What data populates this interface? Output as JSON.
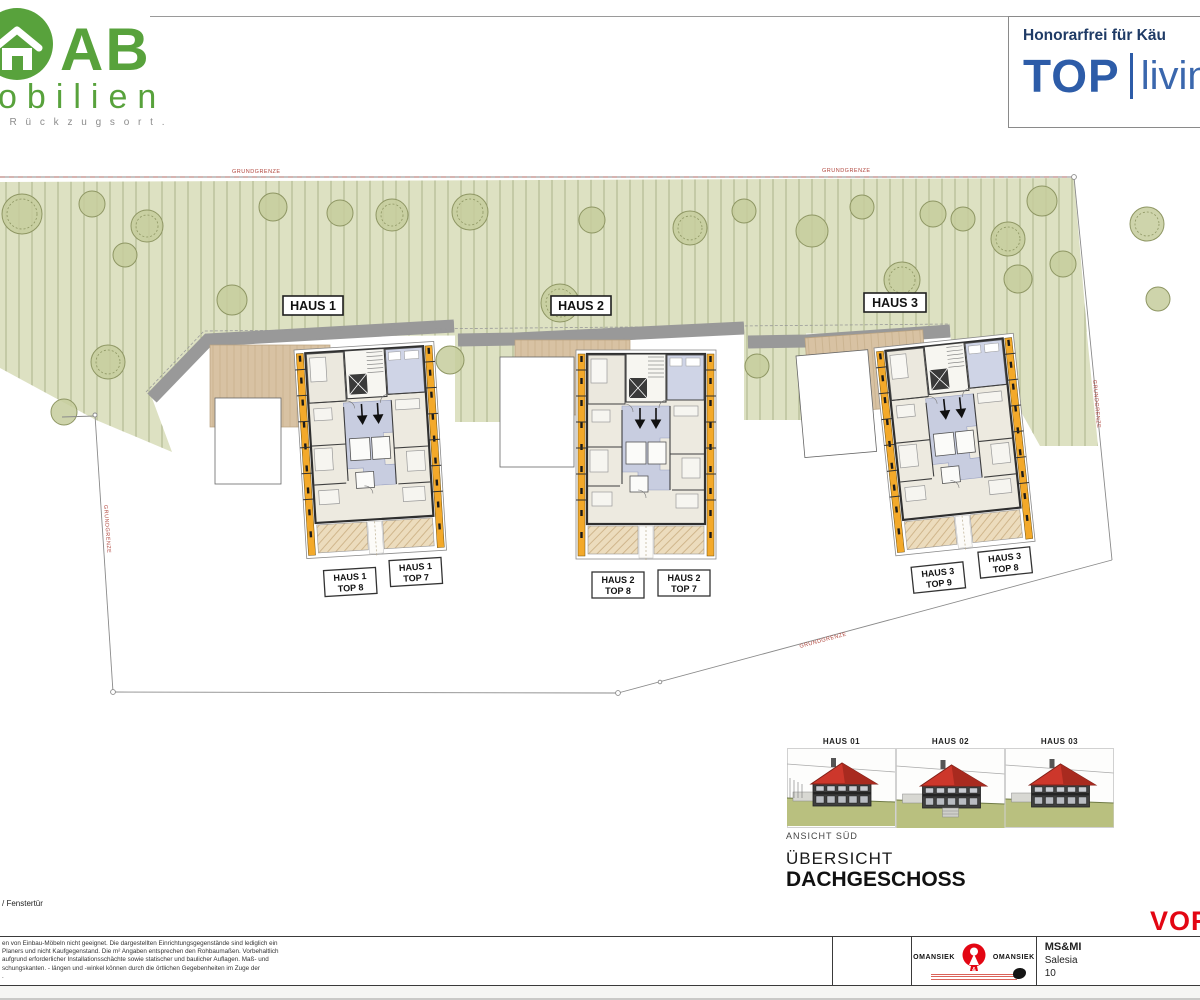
{
  "logo": {
    "brand_big": "AB",
    "brand_rest": "obilien",
    "tagline": ". R ü c k z u g s o r t ."
  },
  "header": {
    "note": "Honorarfrei für Käu",
    "brand": "TOP",
    "brand_living": "livin"
  },
  "site": {
    "boundary_label": "GRUNDGRENZE",
    "houses": [
      {
        "label": "HAUS 1"
      },
      {
        "label": "HAUS 2"
      },
      {
        "label": "HAUS 3"
      }
    ],
    "units": [
      {
        "line1": "HAUS 1",
        "line2": "TOP 8"
      },
      {
        "line1": "HAUS 1",
        "line2": "TOP 7"
      },
      {
        "line1": "HAUS 2",
        "line2": "TOP 8"
      },
      {
        "line1": "HAUS 2",
        "line2": "TOP 7"
      },
      {
        "line1": "HAUS 3",
        "line2": "TOP 9"
      },
      {
        "line1": "HAUS 3",
        "line2": "TOP 8"
      }
    ]
  },
  "elevation": {
    "houses": [
      "HAUS 01",
      "HAUS 02",
      "HAUS 03"
    ],
    "caption": "ANSICHT SÜD",
    "title1": "ÜBERSICHT",
    "title2": "DACHGESCHOSS"
  },
  "legend": {
    "window_note": "/ Fenstertür"
  },
  "disclaimer": {
    "lines": [
      "en von Einbau-Möbeln nicht geeignet. Die dargestellten Einrichtungsgegenstände sind lediglich ein",
      "Planers und nicht Kaufgegenstand. Die m² Angaben entsprechen den Rohbaumaßen. Vorbehaltlich",
      "aufgrund erforderlicher Installationsschächte sowie statischer und baulicher Auflagen. Maß- und",
      "schungskanten. - längen und -winkel können durch die örtlichen Gegebenheiten im Zuge der",
      "."
    ]
  },
  "titleblock": {
    "architect_left": "OMANSIEK",
    "architect_right": "OMANSIEK",
    "logo_amp": "&",
    "client_line1": "MS&MI",
    "client_line2": "Salesia",
    "client_line3": "10",
    "stamp": "VOR"
  },
  "colors": {
    "logo_green": "#58a23c",
    "brand_blue": "#2d5ca8",
    "note_navy": "#1f3b66",
    "stamp_red": "#e30613",
    "site_green": "#dde1c2",
    "deck_beige": "#d8c2a3",
    "eave_yellow": "#f3a92a",
    "hall_blue": "#c8cde0",
    "roof_red": "#cd372b"
  }
}
